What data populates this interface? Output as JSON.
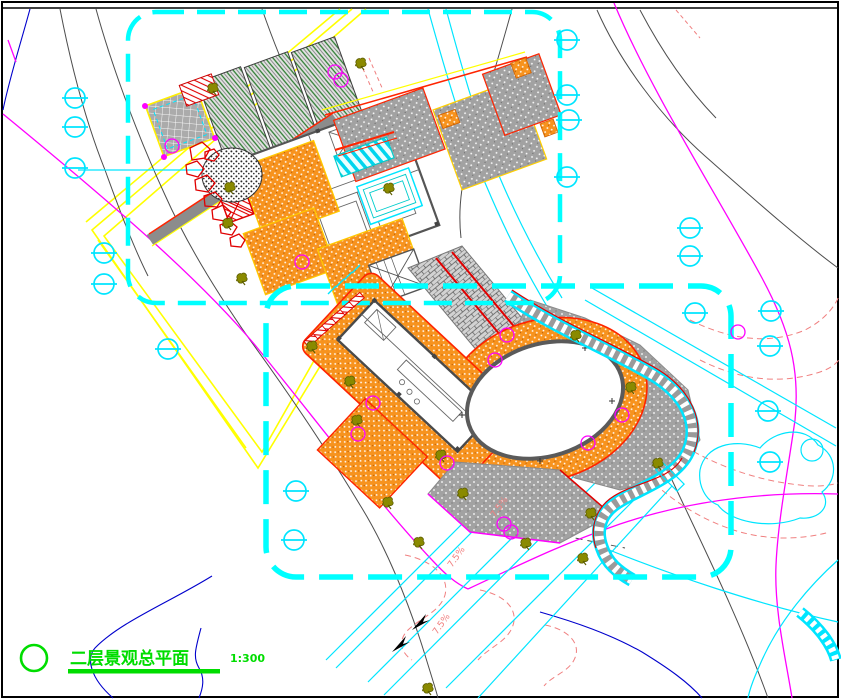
{
  "drawing": {
    "title": "二层景观总平面",
    "scale": "1:300",
    "slope_labels": [
      "7.5%",
      "7.5%",
      "7.5%"
    ],
    "symbols": {
      "manhole": "circle-with-bar-icon",
      "tree": "olive-tree-scribble-icon",
      "shrub": "magenta-circle-icon",
      "rock": "red-stone-outline-icon"
    },
    "colors": {
      "boundary_cyan": "#00ffff",
      "deck_orange": "#f7931e",
      "parcel_magenta": "#ff00ff",
      "contour_gray": "#4d4d4d",
      "contour_blue": "#0000cc",
      "contour_salmon": "#f08080",
      "survey_yellow": "#ffff00",
      "title_green": "#00dd00",
      "edge_red": "#ff2400",
      "tree_olive": "#808000"
    }
  }
}
